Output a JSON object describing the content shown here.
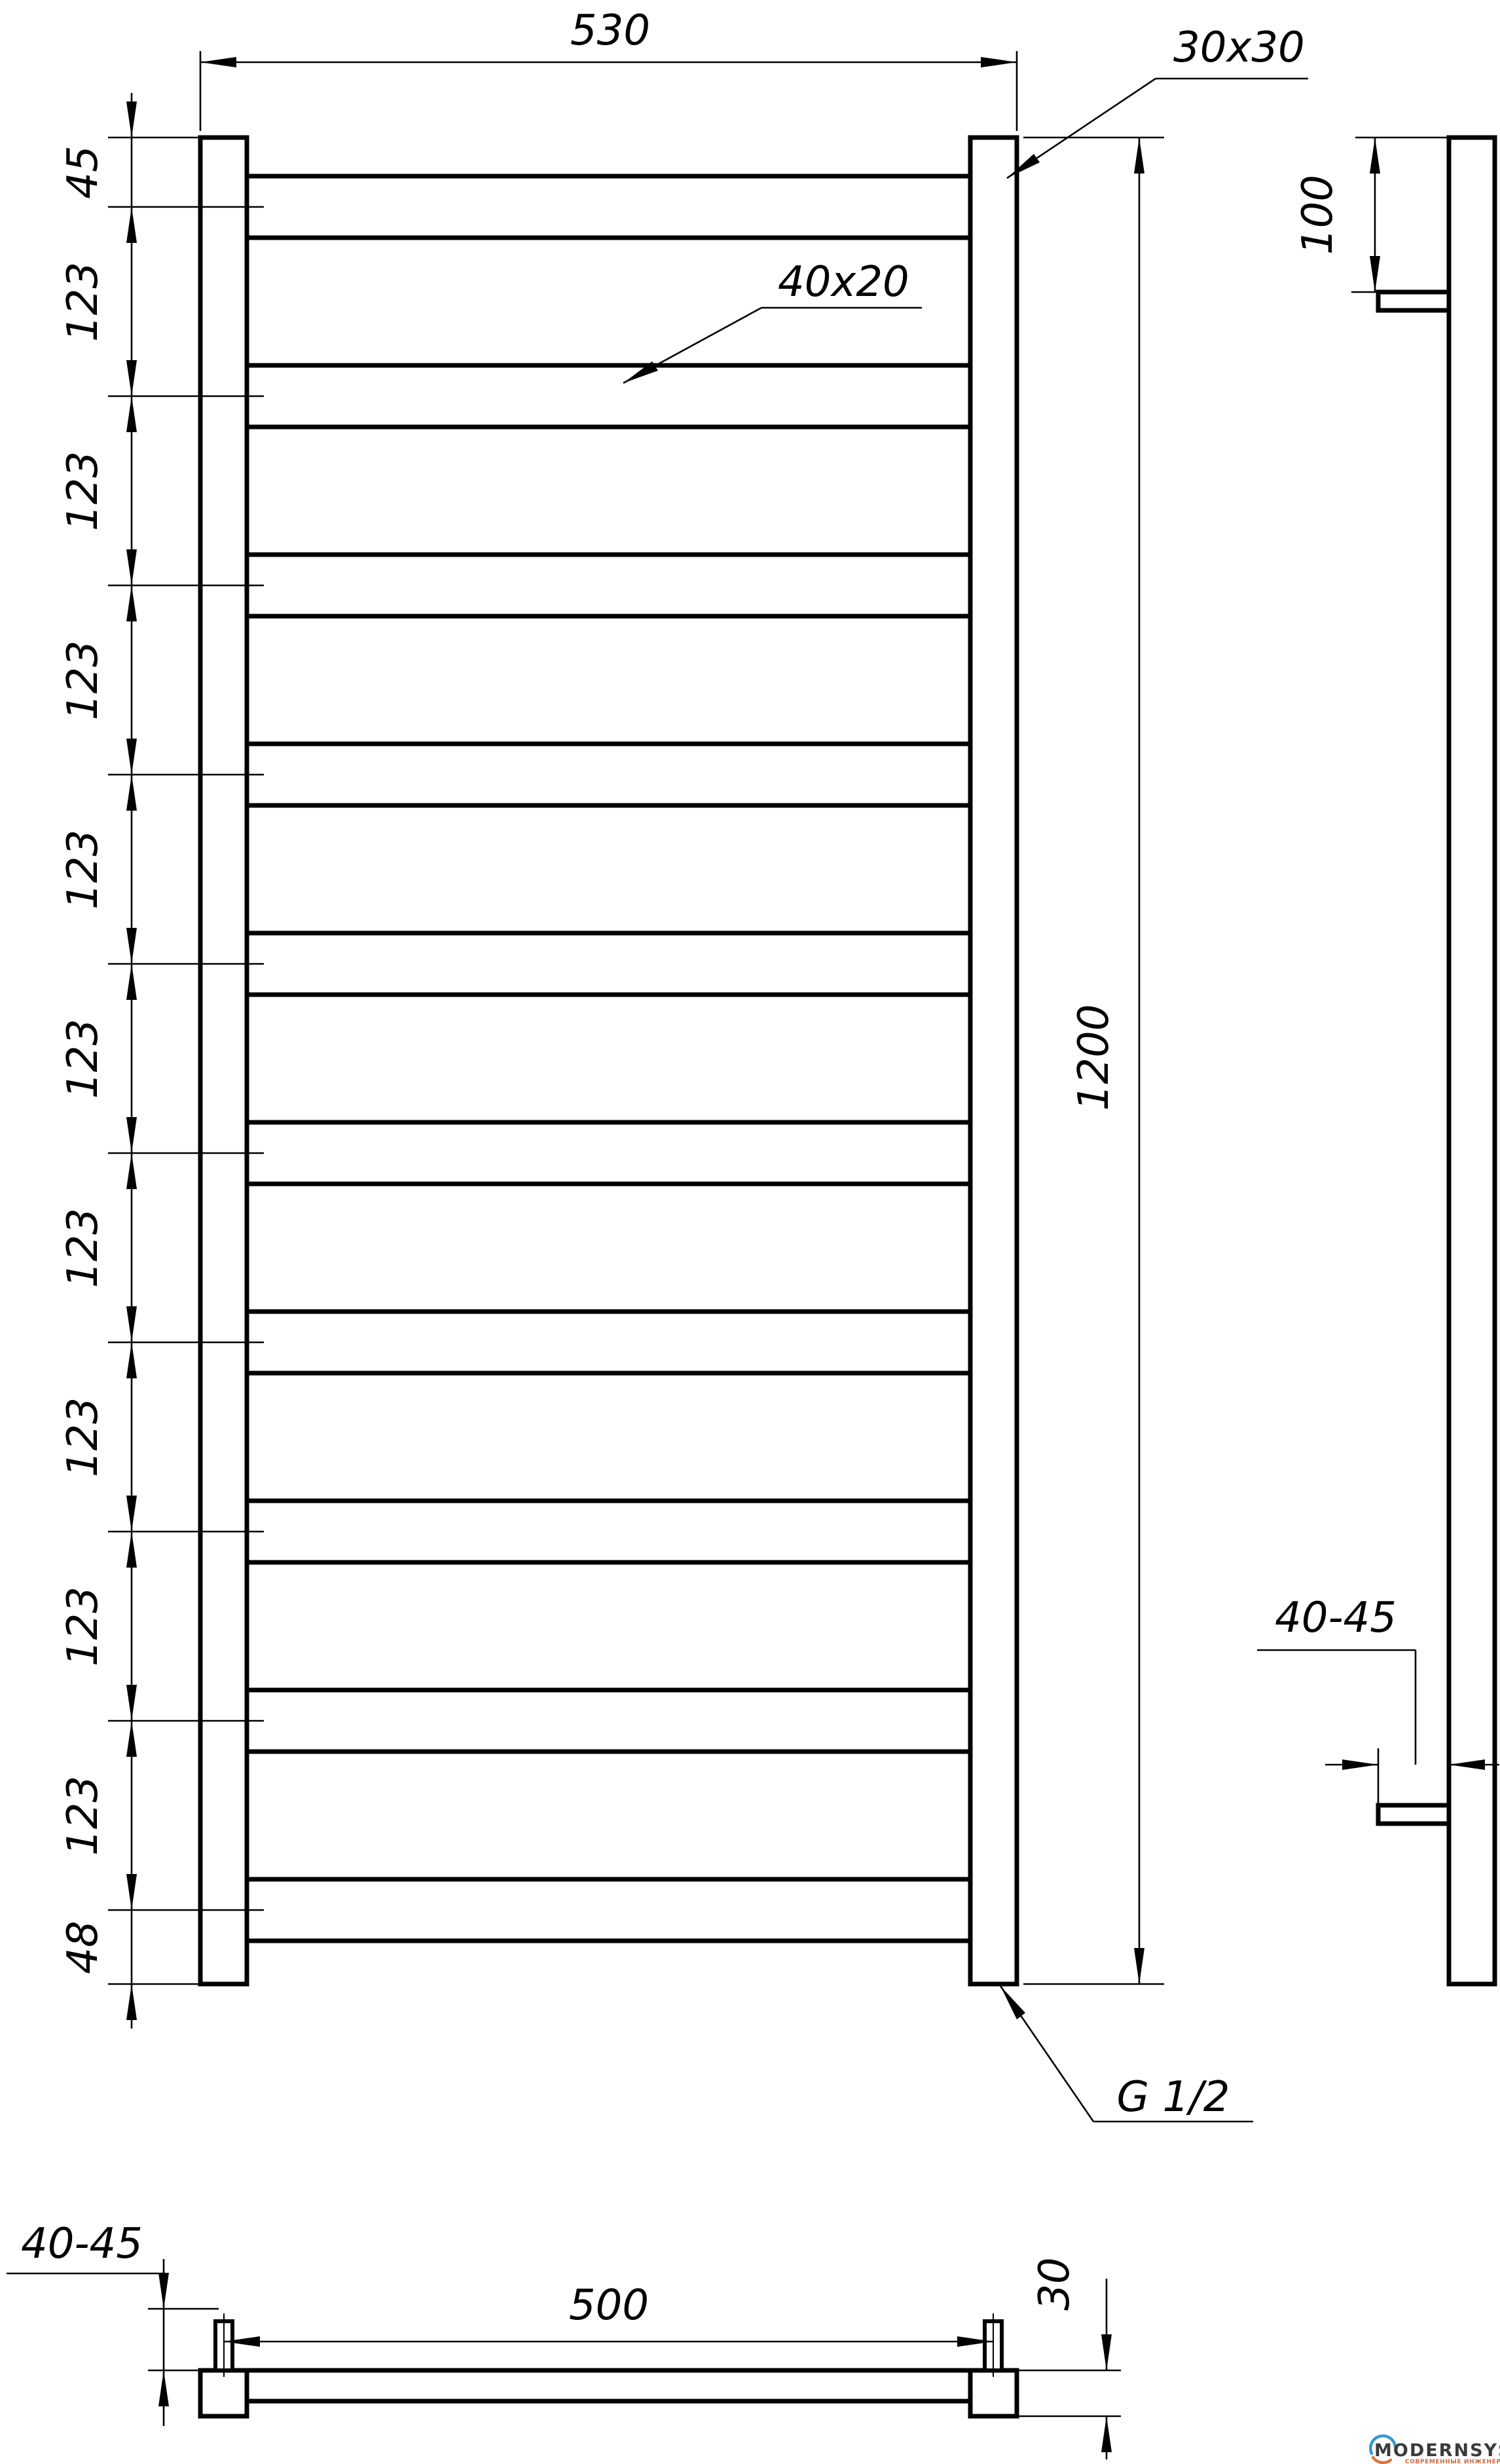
{
  "front": {
    "width_label": "530",
    "post_label": "30x30",
    "rung_label": "40x20",
    "height_label": "1200",
    "thread_label": "G 1/2",
    "chain_labels": [
      "45",
      "123",
      "123",
      "123",
      "123",
      "123",
      "123",
      "123",
      "123",
      "123",
      "48"
    ]
  },
  "side": {
    "offset_label": "100",
    "wall_label": "40-45"
  },
  "bottom": {
    "span_label": "500",
    "post_label": "30",
    "wall_label": "40-45"
  },
  "logo": {
    "name": "MODERNSYS",
    "tagline": "СОВРЕМЕННЫЕ ИНЖЕНЕРНЫЕ СИСТЕМЫ"
  },
  "colors": {
    "line": "#000000",
    "background": "#ffffff",
    "logo_blue": "#3599cf",
    "logo_orange": "#e2703c",
    "logo_text": "#3a3a3c",
    "logo_tagline": "#cf6840"
  }
}
